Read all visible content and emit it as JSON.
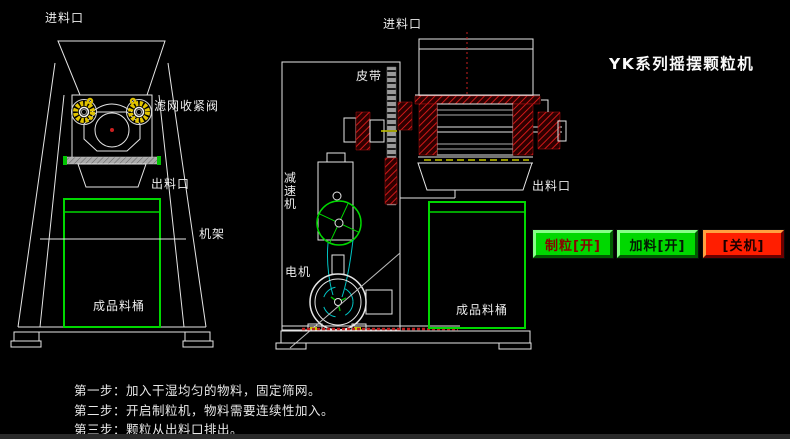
{
  "app": {
    "title": "YK系列摇摆颗粒机"
  },
  "front_view": {
    "labels": {
      "inlet": "进料口",
      "sieve_valve": "滤网收紧阀",
      "outlet": "出料口",
      "frame": "机架",
      "product_barrel": "成品料桶"
    }
  },
  "side_view": {
    "labels": {
      "inlet": "进料口",
      "belt": "皮带",
      "reducer": "减速机",
      "motor": "电机",
      "outlet": "出料口",
      "product_barrel": "成品料桶"
    }
  },
  "controls": {
    "buttons": [
      {
        "label": "制粒[开]",
        "state": "on",
        "color": "#00d800",
        "text_color": "#8b0000"
      },
      {
        "label": "加料[开]",
        "state": "on",
        "color": "#00d800",
        "text_color": "#041a04"
      },
      {
        "label": "[关机]",
        "state": "off",
        "color": "#ff1e00",
        "text_color": "#1a0000"
      }
    ]
  },
  "instructions": {
    "steps": [
      "第一步：加入干湿均匀的物料，固定筛网。",
      "第二步：开启制粒机，物料需要连续性加入。",
      "第三步：颗粒从出料口排出。"
    ]
  },
  "colors": {
    "background": "#000000",
    "line_white": "#e6e6e6",
    "accent_green": "#00d800",
    "hatch_red": "#c41414",
    "belt_cyan": "#00c4c4",
    "knob_yellow": "#e2c400"
  }
}
